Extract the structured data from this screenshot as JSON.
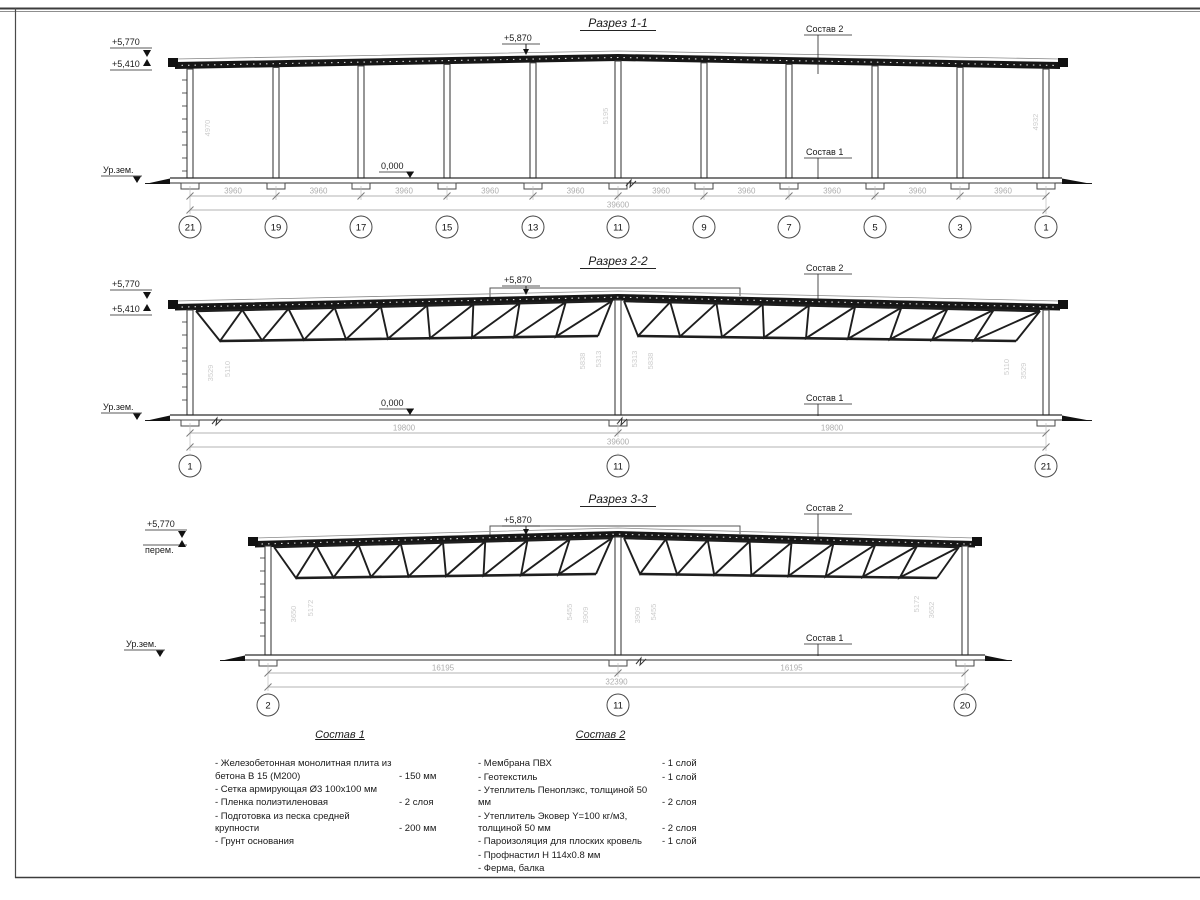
{
  "sections": {
    "s1": {
      "title": "Разрез 1-1",
      "elev_top": "+5,770",
      "elev_eave": "+5,410",
      "elev_ridge": "+5,870",
      "ground_label": "Ур.зем.",
      "zero_label": "0,000",
      "layer2_label": "Состав 2",
      "layer1_label": "Состав 1",
      "bay_dim": "3960",
      "total_dim": "39600",
      "axes": [
        "21",
        "19",
        "17",
        "15",
        "13",
        "11",
        "9",
        "7",
        "5",
        "3",
        "1"
      ],
      "height_dims": [
        "4970",
        "5195",
        "4932"
      ]
    },
    "s2": {
      "title": "Разрез 2-2",
      "elev_top": "+5,770",
      "elev_eave": "+5,410",
      "elev_ridge": "+5,870",
      "ground_label": "Ур.зем.",
      "zero_label": "0,000",
      "layer2_label": "Состав 2",
      "layer1_label": "Состав 1",
      "half_dim": "19800",
      "total_dim": "39600",
      "axes": [
        "1",
        "11",
        "21"
      ],
      "height_dims": [
        "3529",
        "5110",
        "5838",
        "5313",
        "5313",
        "5838",
        "5110",
        "3529"
      ]
    },
    "s3": {
      "title": "Разрез 3-3",
      "elev_top": "+5,770",
      "elev_note": "перем.",
      "elev_ridge": "+5,870",
      "ground_label": "Ур.зем.",
      "layer2_label": "Состав 2",
      "layer1_label": "Состав 1",
      "half_dim": "16195",
      "total_dim": "32390",
      "axes": [
        "2",
        "11",
        "20"
      ],
      "height_dims": [
        "3650",
        "5172",
        "5455",
        "3909",
        "3909",
        "5455",
        "5172",
        "3652"
      ]
    }
  },
  "legend1": {
    "title": "Состав 1",
    "items": [
      {
        "name": "- Железобетонная  монолитная плита из бетона В 15 (М200)",
        "value": "- 150 мм"
      },
      {
        "name": "- Сетка армирующая Ø3 100х100 мм",
        "value": ""
      },
      {
        "name": "- Пленка полиэтиленовая",
        "value": "-  2 слоя"
      },
      {
        "name": "- Подготовка из песка средней крупности",
        "value": "- 200 мм"
      },
      {
        "name": "- Грунт основания",
        "value": ""
      }
    ]
  },
  "legend2": {
    "title": "Состав 2",
    "items": [
      {
        "name": "- Мембрана ПВХ",
        "value": "- 1 слой"
      },
      {
        "name": "- Геотекстиль",
        "value": "- 1 слой"
      },
      {
        "name": "- Утеплитель Пеноплэкс, толщиной 50 мм",
        "value": "- 2 слоя"
      },
      {
        "name": "- Утеплитель Эковер Y=100 кг/м3, толщиной 50 мм",
        "value": "- 2 слоя"
      },
      {
        "name": "- Пароизоляция для плоских кровель",
        "value": "- 1 слой"
      },
      {
        "name": "- Профнастил Н 114х0.8 мм",
        "value": ""
      },
      {
        "name": "- Ферма, балка",
        "value": ""
      }
    ]
  }
}
